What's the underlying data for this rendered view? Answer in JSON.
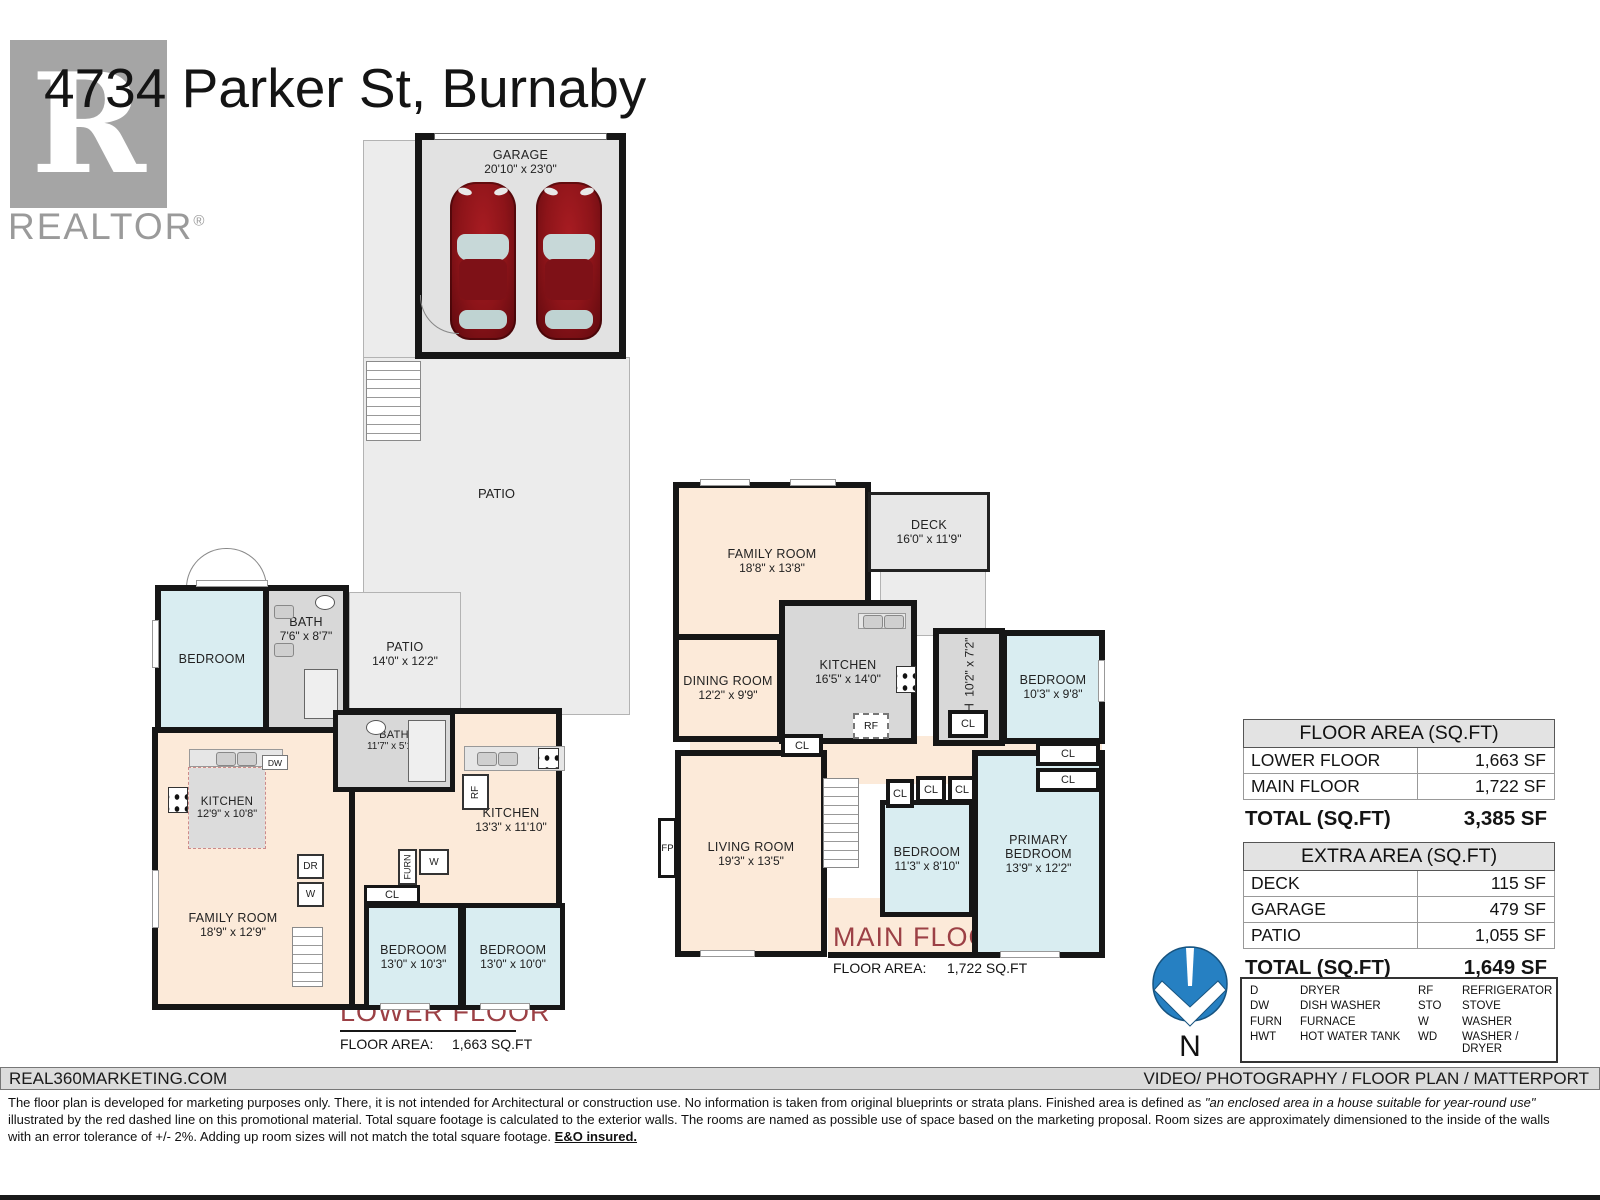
{
  "header": {
    "title": "4734 Parker St, Burnaby",
    "logo_letter": "R",
    "logo_brand": "REALTOR",
    "logo_reg": "®"
  },
  "labels": {
    "cl": "CL",
    "rf": "RF",
    "fp": "FP",
    "dw": "DW",
    "dr": "DR",
    "w": "W",
    "furn": "FURN"
  },
  "garage": {
    "name": "GARAGE",
    "dims": "20'10\" x 23'0\""
  },
  "patio_main": {
    "name": "PATIO"
  },
  "lower_floor": {
    "title": "LOWER FLOOR",
    "area_label": "FLOOR AREA:",
    "area_value": "1,663 SQ.FT",
    "rooms": {
      "bedroom_nw": {
        "name": "BEDROOM"
      },
      "bath_upper": {
        "name": "BATH",
        "dims": "7'6\" x 8'7\""
      },
      "patio_small": {
        "name": "PATIO",
        "dims": "14'0\" x 12'2\""
      },
      "kitchen_west": {
        "name": "KITCHEN",
        "dims": "12'9\" x 10'8\""
      },
      "bath_mid": {
        "name": "BATH",
        "dims": "11'7\" x 5'10\""
      },
      "kitchen_east": {
        "name": "KITCHEN",
        "dims": "13'3\" x 11'10\""
      },
      "family_room": {
        "name": "FAMILY ROOM",
        "dims": "18'9\" x 12'9\""
      },
      "bedroom_sw": {
        "name": "BEDROOM",
        "dims": "13'0\" x 10'3\""
      },
      "bedroom_se": {
        "name": "BEDROOM",
        "dims": "13'0\" x 10'0\""
      }
    }
  },
  "main_floor": {
    "title": "MAIN FLOOR",
    "area_label": "FLOOR AREA:",
    "area_value": "1,722 SQ.FT",
    "rooms": {
      "family_room": {
        "name": "FAMILY ROOM",
        "dims": "18'8\" x 13'8\""
      },
      "deck": {
        "name": "DECK",
        "dims": "16'0\" x 11'9\""
      },
      "dining": {
        "name": "DINING ROOM",
        "dims": "12'2\" x 9'9\""
      },
      "kitchen": {
        "name": "KITCHEN",
        "dims": "16'5\" x 14'0\""
      },
      "bath": {
        "name": "BATH",
        "dims": "10'2\" x 7'2\""
      },
      "bedroom_ne": {
        "name": "BEDROOM",
        "dims": "10'3\" x 9'8\""
      },
      "living": {
        "name": "LIVING ROOM",
        "dims": "19'3\" x 13'5\""
      },
      "bedroom_mid": {
        "name": "BEDROOM",
        "dims": "11'3\" x 8'10\""
      },
      "primary_line1": "PRIMARY",
      "primary_line2": "BEDROOM",
      "primary_dims": "13'9\" x 12'2\""
    }
  },
  "tables": {
    "floor_area": {
      "header": "FLOOR AREA (SQ.FT)",
      "rows": [
        {
          "label": "LOWER FLOOR",
          "value": "1,663 SF"
        },
        {
          "label": "MAIN FLOOR",
          "value": "1,722 SF"
        }
      ],
      "total_label": "TOTAL (SQ.FT)",
      "total_value": "3,385 SF"
    },
    "extra_area": {
      "header": "EXTRA AREA (SQ.FT)",
      "rows": [
        {
          "label": "DECK",
          "value": "115 SF"
        },
        {
          "label": "GARAGE",
          "value": "479 SF"
        },
        {
          "label": "PATIO",
          "value": "1,055 SF"
        }
      ],
      "total_label": "TOTAL (SQ.FT)",
      "total_value": "1,649 SF"
    }
  },
  "legend": {
    "items": [
      {
        "abbr": "D",
        "label": "DRYER"
      },
      {
        "abbr": "RF",
        "label": "REFRIGERATOR"
      },
      {
        "abbr": "DW",
        "label": "DISH WASHER"
      },
      {
        "abbr": "STO",
        "label": "STOVE"
      },
      {
        "abbr": "FURN",
        "label": "FURNACE"
      },
      {
        "abbr": "W",
        "label": "WASHER"
      },
      {
        "abbr": "HWT",
        "label": "HOT WATER TANK"
      },
      {
        "abbr": "WD",
        "label": "WASHER / DRYER"
      }
    ]
  },
  "compass": {
    "label": "N"
  },
  "footer": {
    "left": "REAL360MARKETING.COM",
    "right": "VIDEO/ PHOTOGRAPHY / FLOOR PLAN / MATTERPORT",
    "disclaimer_part1": "The floor plan is developed for marketing purposes only. There, it is not intended for Architectural or construction use. No information is taken from original blueprints or strata plans. Finished area is defined as ",
    "disclaimer_italic": "\"an enclosed area in a house suitable for year-round use\"",
    "disclaimer_part2": " illustrated by the red dashed line on this promotional material. Total square footage is calculated to the exterior walls. The rooms are named as possible use of space based on the marketing proposal. Room sizes are approximately dimensioned to the inside of the walls with an error tolerance of +/- 2%. Adding up room sizes will not match the total square footage. ",
    "disclaimer_bold": "E&O insured."
  }
}
